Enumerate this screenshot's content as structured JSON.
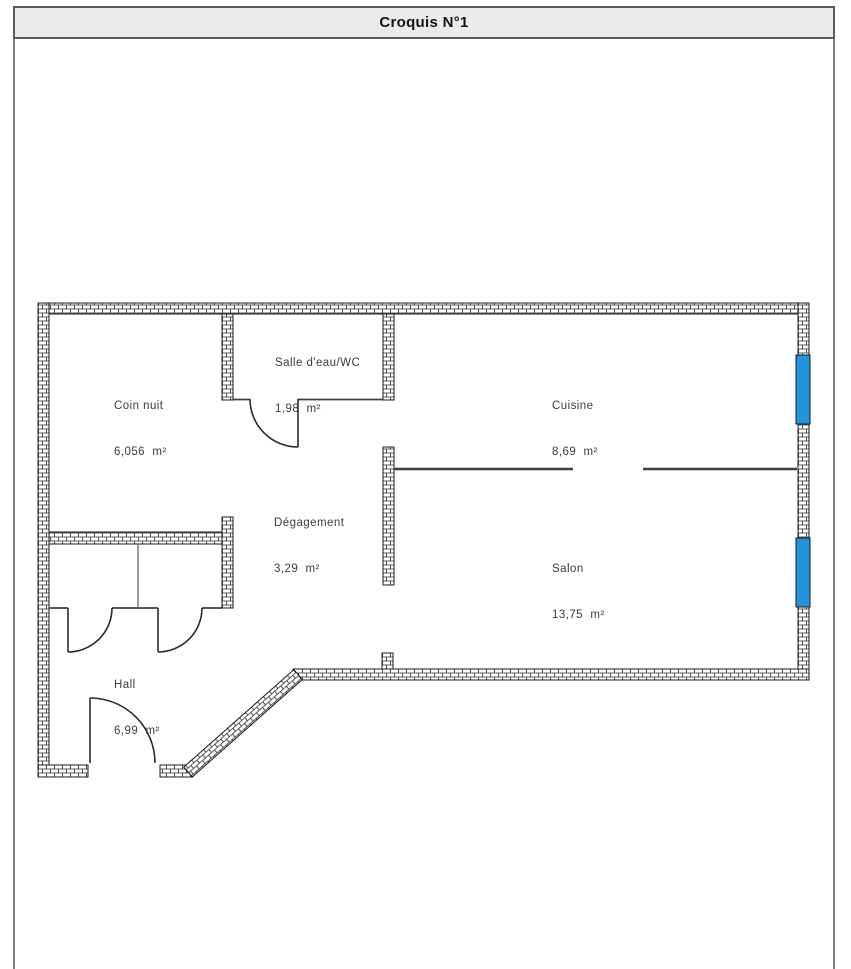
{
  "title": "Croquis N°1",
  "floor_plan": {
    "rooms": [
      {
        "name": "Coin nuit",
        "area": "6,056  m²"
      },
      {
        "name": "Salle d'eau/WC",
        "area": "1,98  m²"
      },
      {
        "name": "Cuisine",
        "area": "8,69  m²"
      },
      {
        "name": "Dégagement",
        "area": "3,29  m²"
      },
      {
        "name": "Salon",
        "area": "13,75  m²"
      },
      {
        "name": "Hall",
        "area": "6,99  m²"
      }
    ],
    "windows_count": 2,
    "colors": {
      "window": "#2394DC",
      "titlebar_bg": "#ebebeb",
      "frame_border": "#5a5a5a",
      "content_border": "#7d7d7d",
      "wall_outline": "#1a1a1a",
      "brick_line": "#2a2a2a",
      "partition": "#3f3f3f",
      "door_line": "#2b2b2b",
      "label_text": "#3c3c3c"
    }
  }
}
